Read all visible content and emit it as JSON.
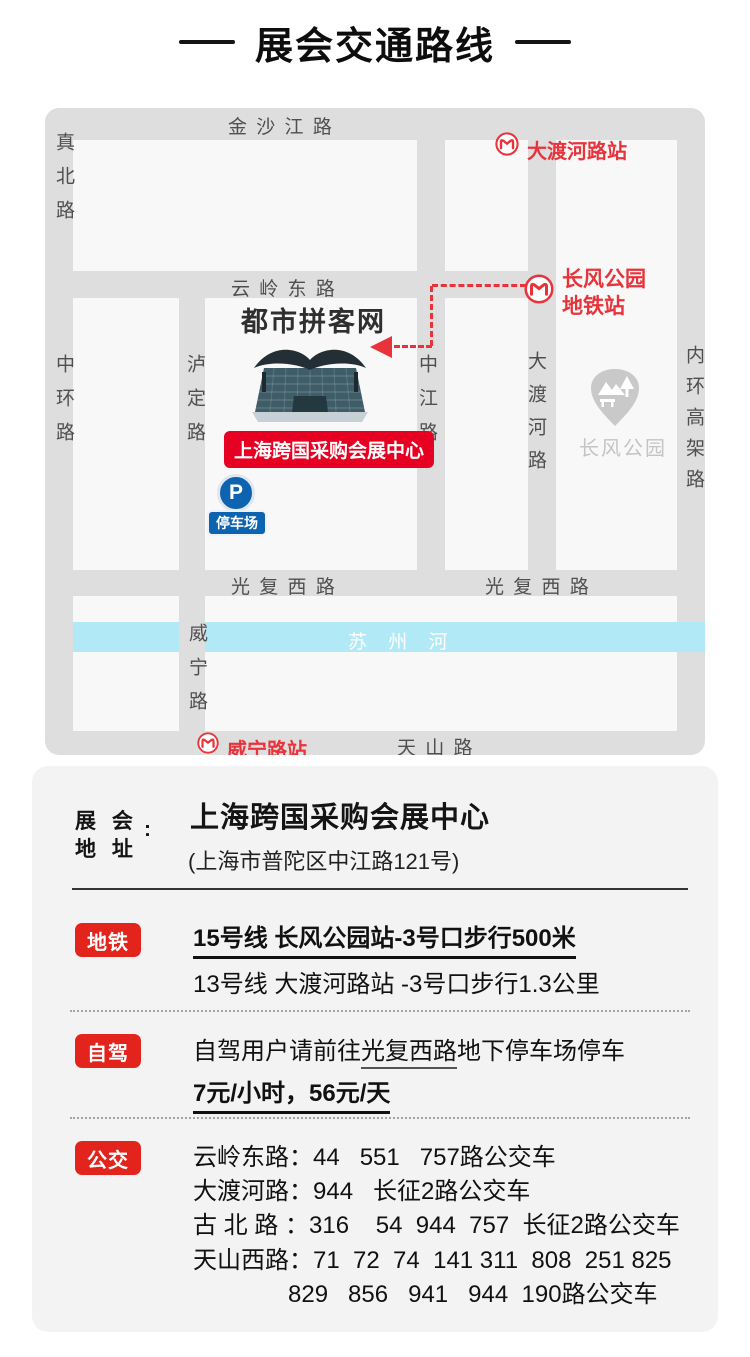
{
  "page": {
    "title": "展会交通路线"
  },
  "colors": {
    "accent_red": "#e2241d",
    "banner_red": "#e60021",
    "metro_red": "#e8333a",
    "river_cyan": "#b2e9f6",
    "parking_blue": "#0e63b0",
    "road_gray": "#dedede",
    "block_gray": "#f8f8f8"
  },
  "map": {
    "roads": {
      "jinshajiang": "金 沙 江 路",
      "zhenbei": "真北路",
      "zhonghuan": "中环路",
      "yunlingdong": "云 岭 东 路",
      "luding": "泸定路",
      "zhongjiang": "中江路",
      "daduhe": "大渡河路",
      "neihuangaojia": "内环高架路",
      "guangfuxi_left": "光 复 西 路",
      "guangfuxi_right": "光 复 西 路",
      "weining": "威宁路",
      "tianshan": "天 山 路"
    },
    "river_label": "苏 州 河",
    "stations": {
      "daduhelu": "大渡河路站",
      "changfeng_line1": "长风公园",
      "changfeng_line2": "地铁站",
      "weininglu": "威宁路站"
    },
    "venue": {
      "watermark": "都市拼客网",
      "banner": "上海跨国采购会展中心"
    },
    "parking": {
      "p": "P",
      "label": "停车场"
    },
    "park": {
      "label": "长风公园"
    }
  },
  "address": {
    "label": "展 会\n地 址",
    "colon": ":",
    "name": "上海跨国采购会展中心",
    "detail": "(上海市普陀区中江路121号)"
  },
  "metro": {
    "badge": "地铁",
    "line1": "15号线 长风公园站-3号口步行500米",
    "line2": "13号线 大渡河路站 -3号口步行1.3公里"
  },
  "drive": {
    "badge": "自驾",
    "line1_prefix": "自驾用户请前往",
    "line1_underlined": "光复西路",
    "line1_suffix": "地下停车场停车",
    "line2": "7元/小时，56元/天"
  },
  "bus": {
    "badge": "公交",
    "lines": [
      "云岭东路：44   551   757路公交车",
      "大渡河路：944   长征2路公交车",
      "古 北 路 ：316    54  944  757  长征2路公交车",
      "天山西路：71  72  74  141 311  808  251 825",
      "829   856   941   944  190路公交车"
    ]
  }
}
